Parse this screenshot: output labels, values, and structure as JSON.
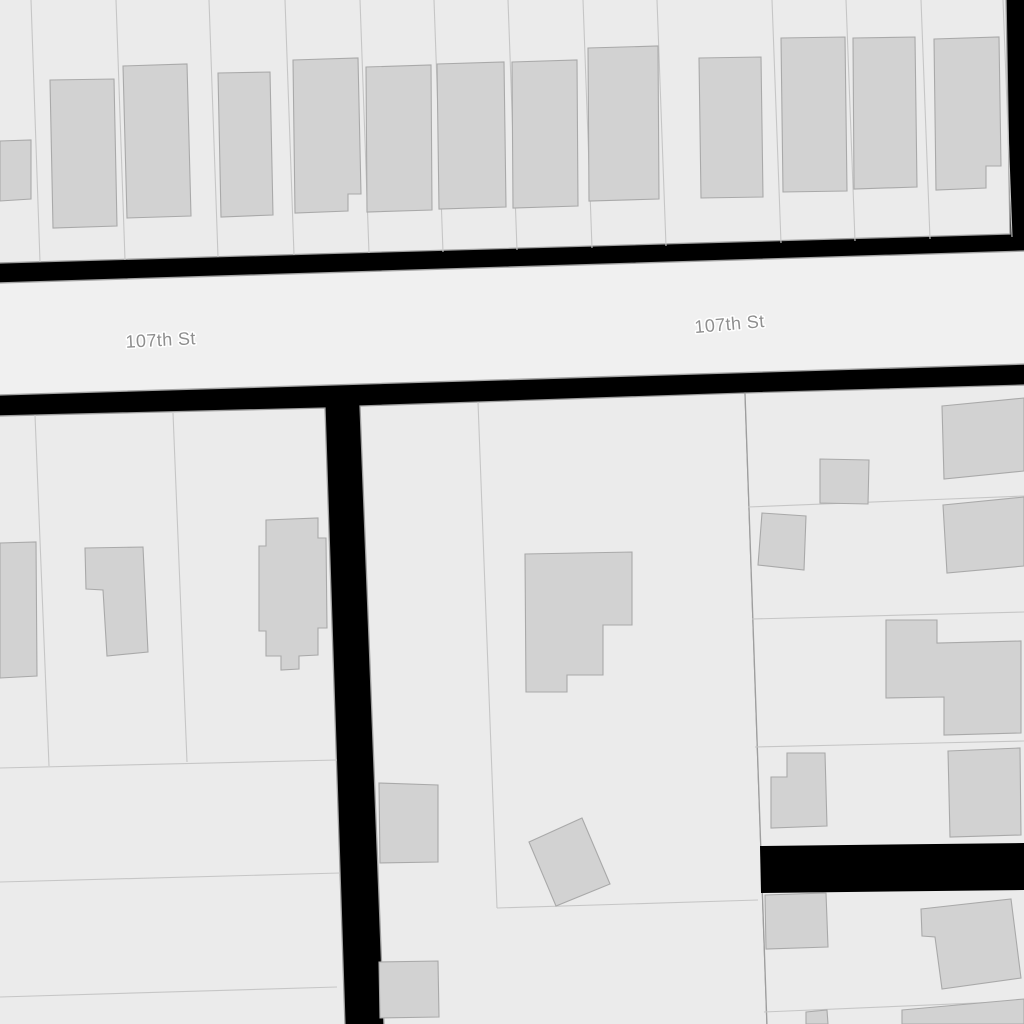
{
  "map": {
    "kind": "cadastral-parcel-map",
    "background": "#000000",
    "colors": {
      "parcel_fill": "#ebebeb",
      "street_fill": "#f0f0f0",
      "building_fill": "#d2d2d2",
      "building_stroke": "#a9a9a9",
      "parcel_line": "#c6c6c6",
      "block_stroke": "#9e9e9e",
      "street_stroke": "#a3a3a3",
      "label_color": "#8e8e8e",
      "label_halo": "#ffffff"
    },
    "street_labels": [
      {
        "text": "107th St",
        "x": 161,
        "y": 346,
        "rotation": -3,
        "size": 18
      },
      {
        "text": "107th St",
        "x": 730,
        "y": 330,
        "rotation": -5,
        "size": 18
      }
    ],
    "streets": [
      {
        "name": "107th St",
        "points": [
          [
            -2,
            283
          ],
          [
            1026,
            251
          ],
          [
            1026,
            364
          ],
          [
            -2,
            395
          ]
        ]
      }
    ],
    "blocks": [
      {
        "name": "block-north",
        "points": [
          [
            -2,
            -2
          ],
          [
            1006,
            -2
          ],
          [
            1010,
            234
          ],
          [
            -2,
            263
          ]
        ]
      },
      {
        "name": "block-southwest",
        "points": [
          [
            -2,
            416
          ],
          [
            325,
            408
          ],
          [
            345,
            1026
          ],
          [
            -2,
            1026
          ]
        ]
      },
      {
        "name": "block-south-middle",
        "points": [
          [
            360,
            406
          ],
          [
            745,
            393
          ],
          [
            767,
            1026
          ],
          [
            384,
            1026
          ]
        ]
      },
      {
        "name": "block-southeast",
        "points": [
          [
            745,
            393
          ],
          [
            1026,
            385
          ],
          [
            1026,
            1026
          ],
          [
            767,
            1026
          ]
        ]
      }
    ],
    "black_patches": [
      {
        "name": "alley-gap",
        "points": [
          [
            760,
            846
          ],
          [
            1026,
            843
          ],
          [
            1026,
            890
          ],
          [
            761,
            893
          ]
        ]
      }
    ],
    "parcel_lines": [
      [
        [
          31,
          0
        ],
        [
          40,
          262
        ]
      ],
      [
        [
          116,
          0
        ],
        [
          125,
          260
        ]
      ],
      [
        [
          209,
          0
        ],
        [
          218,
          257
        ]
      ],
      [
        [
          285,
          0
        ],
        [
          294,
          255
        ]
      ],
      [
        [
          360,
          0
        ],
        [
          369,
          253
        ]
      ],
      [
        [
          434,
          0
        ],
        [
          443,
          252
        ]
      ],
      [
        [
          508,
          0
        ],
        [
          517,
          250
        ]
      ],
      [
        [
          583,
          0
        ],
        [
          592,
          248
        ]
      ],
      [
        [
          657,
          0
        ],
        [
          666,
          246
        ]
      ],
      [
        [
          772,
          0
        ],
        [
          781,
          243
        ]
      ],
      [
        [
          846,
          0
        ],
        [
          855,
          241
        ]
      ],
      [
        [
          921,
          0
        ],
        [
          930,
          239
        ]
      ],
      [
        [
          1003,
          0
        ],
        [
          1012,
          237
        ]
      ],
      [
        [
          35,
          415
        ],
        [
          49,
          766
        ]
      ],
      [
        [
          173,
          413
        ],
        [
          187,
          762
        ]
      ],
      [
        [
          0,
          768
        ],
        [
          337,
          760
        ]
      ],
      [
        [
          0,
          882
        ],
        [
          340,
          873
        ]
      ],
      [
        [
          0,
          997
        ],
        [
          337,
          987
        ]
      ],
      [
        [
          478,
          402
        ],
        [
          497,
          908
        ]
      ],
      [
        [
          497,
          908
        ],
        [
          758,
          900
        ]
      ],
      [
        [
          748,
          507
        ],
        [
          1024,
          496
        ]
      ],
      [
        [
          752,
          619
        ],
        [
          1024,
          612
        ]
      ],
      [
        [
          755,
          747
        ],
        [
          1024,
          741
        ]
      ],
      [
        [
          764,
          1012
        ],
        [
          1024,
          1001
        ]
      ]
    ],
    "buildings": [
      {
        "points": [
          [
            0,
            141
          ],
          [
            31,
            140
          ],
          [
            31,
            199
          ],
          [
            0,
            201
          ]
        ]
      },
      {
        "points": [
          [
            50,
            80
          ],
          [
            114,
            79
          ],
          [
            117,
            226
          ],
          [
            53,
            228
          ]
        ]
      },
      {
        "points": [
          [
            123,
            66
          ],
          [
            187,
            64
          ],
          [
            191,
            216
          ],
          [
            127,
            218
          ]
        ]
      },
      {
        "points": [
          [
            218,
            73
          ],
          [
            270,
            72
          ],
          [
            273,
            215
          ],
          [
            221,
            217
          ]
        ]
      },
      {
        "points": [
          [
            293,
            60
          ],
          [
            358,
            58
          ],
          [
            361,
            194
          ],
          [
            348,
            194
          ],
          [
            348,
            211
          ],
          [
            295,
            213
          ]
        ]
      },
      {
        "points": [
          [
            366,
            67
          ],
          [
            431,
            65
          ],
          [
            432,
            210
          ],
          [
            367,
            212
          ]
        ]
      },
      {
        "points": [
          [
            437,
            64
          ],
          [
            504,
            62
          ],
          [
            506,
            207
          ],
          [
            439,
            209
          ]
        ]
      },
      {
        "points": [
          [
            512,
            62
          ],
          [
            577,
            60
          ],
          [
            578,
            206
          ],
          [
            513,
            208
          ]
        ]
      },
      {
        "points": [
          [
            588,
            48
          ],
          [
            658,
            46
          ],
          [
            659,
            199
          ],
          [
            589,
            201
          ]
        ]
      },
      {
        "points": [
          [
            699,
            58
          ],
          [
            761,
            57
          ],
          [
            763,
            197
          ],
          [
            701,
            198
          ]
        ]
      },
      {
        "points": [
          [
            781,
            38
          ],
          [
            845,
            37
          ],
          [
            847,
            191
          ],
          [
            783,
            192
          ]
        ]
      },
      {
        "points": [
          [
            853,
            38
          ],
          [
            915,
            37
          ],
          [
            917,
            187
          ],
          [
            854,
            189
          ]
        ]
      },
      {
        "points": [
          [
            934,
            39
          ],
          [
            999,
            37
          ],
          [
            1001,
            166
          ],
          [
            986,
            166
          ],
          [
            986,
            188
          ],
          [
            936,
            190
          ]
        ]
      },
      {
        "points": [
          [
            0,
            543
          ],
          [
            36,
            542
          ],
          [
            37,
            676
          ],
          [
            0,
            678
          ]
        ]
      },
      {
        "points": [
          [
            85,
            548
          ],
          [
            143,
            547
          ],
          [
            148,
            652
          ],
          [
            107,
            656
          ],
          [
            103,
            590
          ],
          [
            86,
            589
          ]
        ]
      },
      {
        "points": [
          [
            266,
            520
          ],
          [
            318,
            518
          ],
          [
            318,
            538
          ],
          [
            326,
            538
          ],
          [
            327,
            628
          ],
          [
            318,
            628
          ],
          [
            318,
            655
          ],
          [
            299,
            656
          ],
          [
            299,
            669
          ],
          [
            281,
            670
          ],
          [
            281,
            656
          ],
          [
            266,
            656
          ],
          [
            266,
            631
          ],
          [
            259,
            631
          ],
          [
            259,
            546
          ],
          [
            266,
            546
          ]
        ]
      },
      {
        "points": [
          [
            525,
            554
          ],
          [
            632,
            552
          ],
          [
            632,
            625
          ],
          [
            603,
            625
          ],
          [
            603,
            675
          ],
          [
            567,
            675
          ],
          [
            567,
            692
          ],
          [
            526,
            692
          ]
        ]
      },
      {
        "points": [
          [
            529,
            842
          ],
          [
            582,
            818
          ],
          [
            610,
            884
          ],
          [
            556,
            906
          ]
        ]
      },
      {
        "points": [
          [
            379,
            783
          ],
          [
            438,
            785
          ],
          [
            438,
            862
          ],
          [
            380,
            863
          ]
        ]
      },
      {
        "points": [
          [
            379,
            962
          ],
          [
            438,
            961
          ],
          [
            439,
            1017
          ],
          [
            380,
            1018
          ]
        ]
      },
      {
        "points": [
          [
            820,
            459
          ],
          [
            869,
            460
          ],
          [
            868,
            504
          ],
          [
            820,
            503
          ]
        ]
      },
      {
        "points": [
          [
            942,
            406
          ],
          [
            1024,
            398
          ],
          [
            1024,
            471
          ],
          [
            944,
            479
          ]
        ]
      },
      {
        "points": [
          [
            762,
            513
          ],
          [
            806,
            516
          ],
          [
            804,
            570
          ],
          [
            758,
            565
          ]
        ]
      },
      {
        "points": [
          [
            943,
            505
          ],
          [
            1024,
            497
          ],
          [
            1024,
            566
          ],
          [
            947,
            573
          ]
        ]
      },
      {
        "points": [
          [
            886,
            620
          ],
          [
            937,
            620
          ],
          [
            937,
            643
          ],
          [
            1021,
            641
          ],
          [
            1021,
            733
          ],
          [
            944,
            735
          ],
          [
            944,
            697
          ],
          [
            886,
            698
          ]
        ]
      },
      {
        "points": [
          [
            787,
            753
          ],
          [
            825,
            753
          ],
          [
            827,
            826
          ],
          [
            771,
            828
          ],
          [
            771,
            777
          ],
          [
            787,
            777
          ]
        ]
      },
      {
        "points": [
          [
            948,
            751
          ],
          [
            1020,
            748
          ],
          [
            1021,
            835
          ],
          [
            950,
            837
          ]
        ]
      },
      {
        "points": [
          [
            765,
            895
          ],
          [
            826,
            893
          ],
          [
            828,
            947
          ],
          [
            766,
            949
          ]
        ]
      },
      {
        "points": [
          [
            921,
            909
          ],
          [
            1011,
            899
          ],
          [
            1021,
            978
          ],
          [
            942,
            989
          ],
          [
            935,
            937
          ],
          [
            922,
            936
          ]
        ]
      },
      {
        "points": [
          [
            806,
            1012
          ],
          [
            827,
            1010
          ],
          [
            828,
            1024
          ],
          [
            806,
            1024
          ]
        ]
      },
      {
        "points": [
          [
            902,
            1010
          ],
          [
            1024,
            999
          ],
          [
            1024,
            1024
          ],
          [
            902,
            1024
          ]
        ]
      }
    ]
  }
}
